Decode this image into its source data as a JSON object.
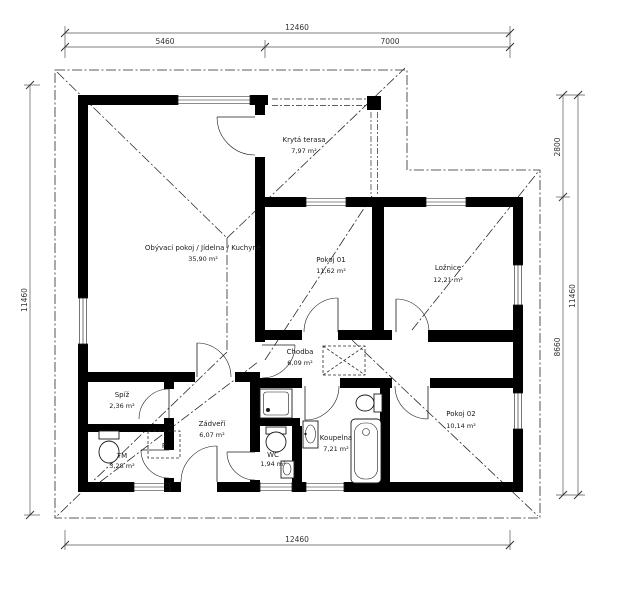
{
  "plan_title": "Family house floor plan",
  "rooms": [
    {
      "name": "Obývací pokoj / Jídelna / Kuchyně",
      "area": "35,90 m²"
    },
    {
      "name": "Krytá terasa",
      "area": "7,97 m²"
    },
    {
      "name": "Pokoj 01",
      "area": "11,62 m²"
    },
    {
      "name": "Ložnice",
      "area": "12,21 m²"
    },
    {
      "name": "Chodba",
      "area": "6,09 m²"
    },
    {
      "name": "Spíž",
      "area": "2,36 m²"
    },
    {
      "name": "Zádveří",
      "area": "6,07 m²"
    },
    {
      "name": "TM",
      "area": "3,28 m²"
    },
    {
      "name": "WC",
      "area": "1,94 m²"
    },
    {
      "name": "Koupelna",
      "area": "7,21 m²"
    },
    {
      "name": "Pokoj 02",
      "area": "10,14 m²"
    }
  ],
  "fixtures": {
    "washing_machine_label": "P"
  },
  "dimensions": {
    "top_total": "12460",
    "top_left": "5460",
    "top_right": "7000",
    "left_total": "11460",
    "right_upper": "2800",
    "right_lower": "8660",
    "right_total": "11460",
    "bottom_total": "12460"
  },
  "colors": {
    "wall": "#000000",
    "line": "#1a1a1a",
    "background": "#ffffff"
  }
}
